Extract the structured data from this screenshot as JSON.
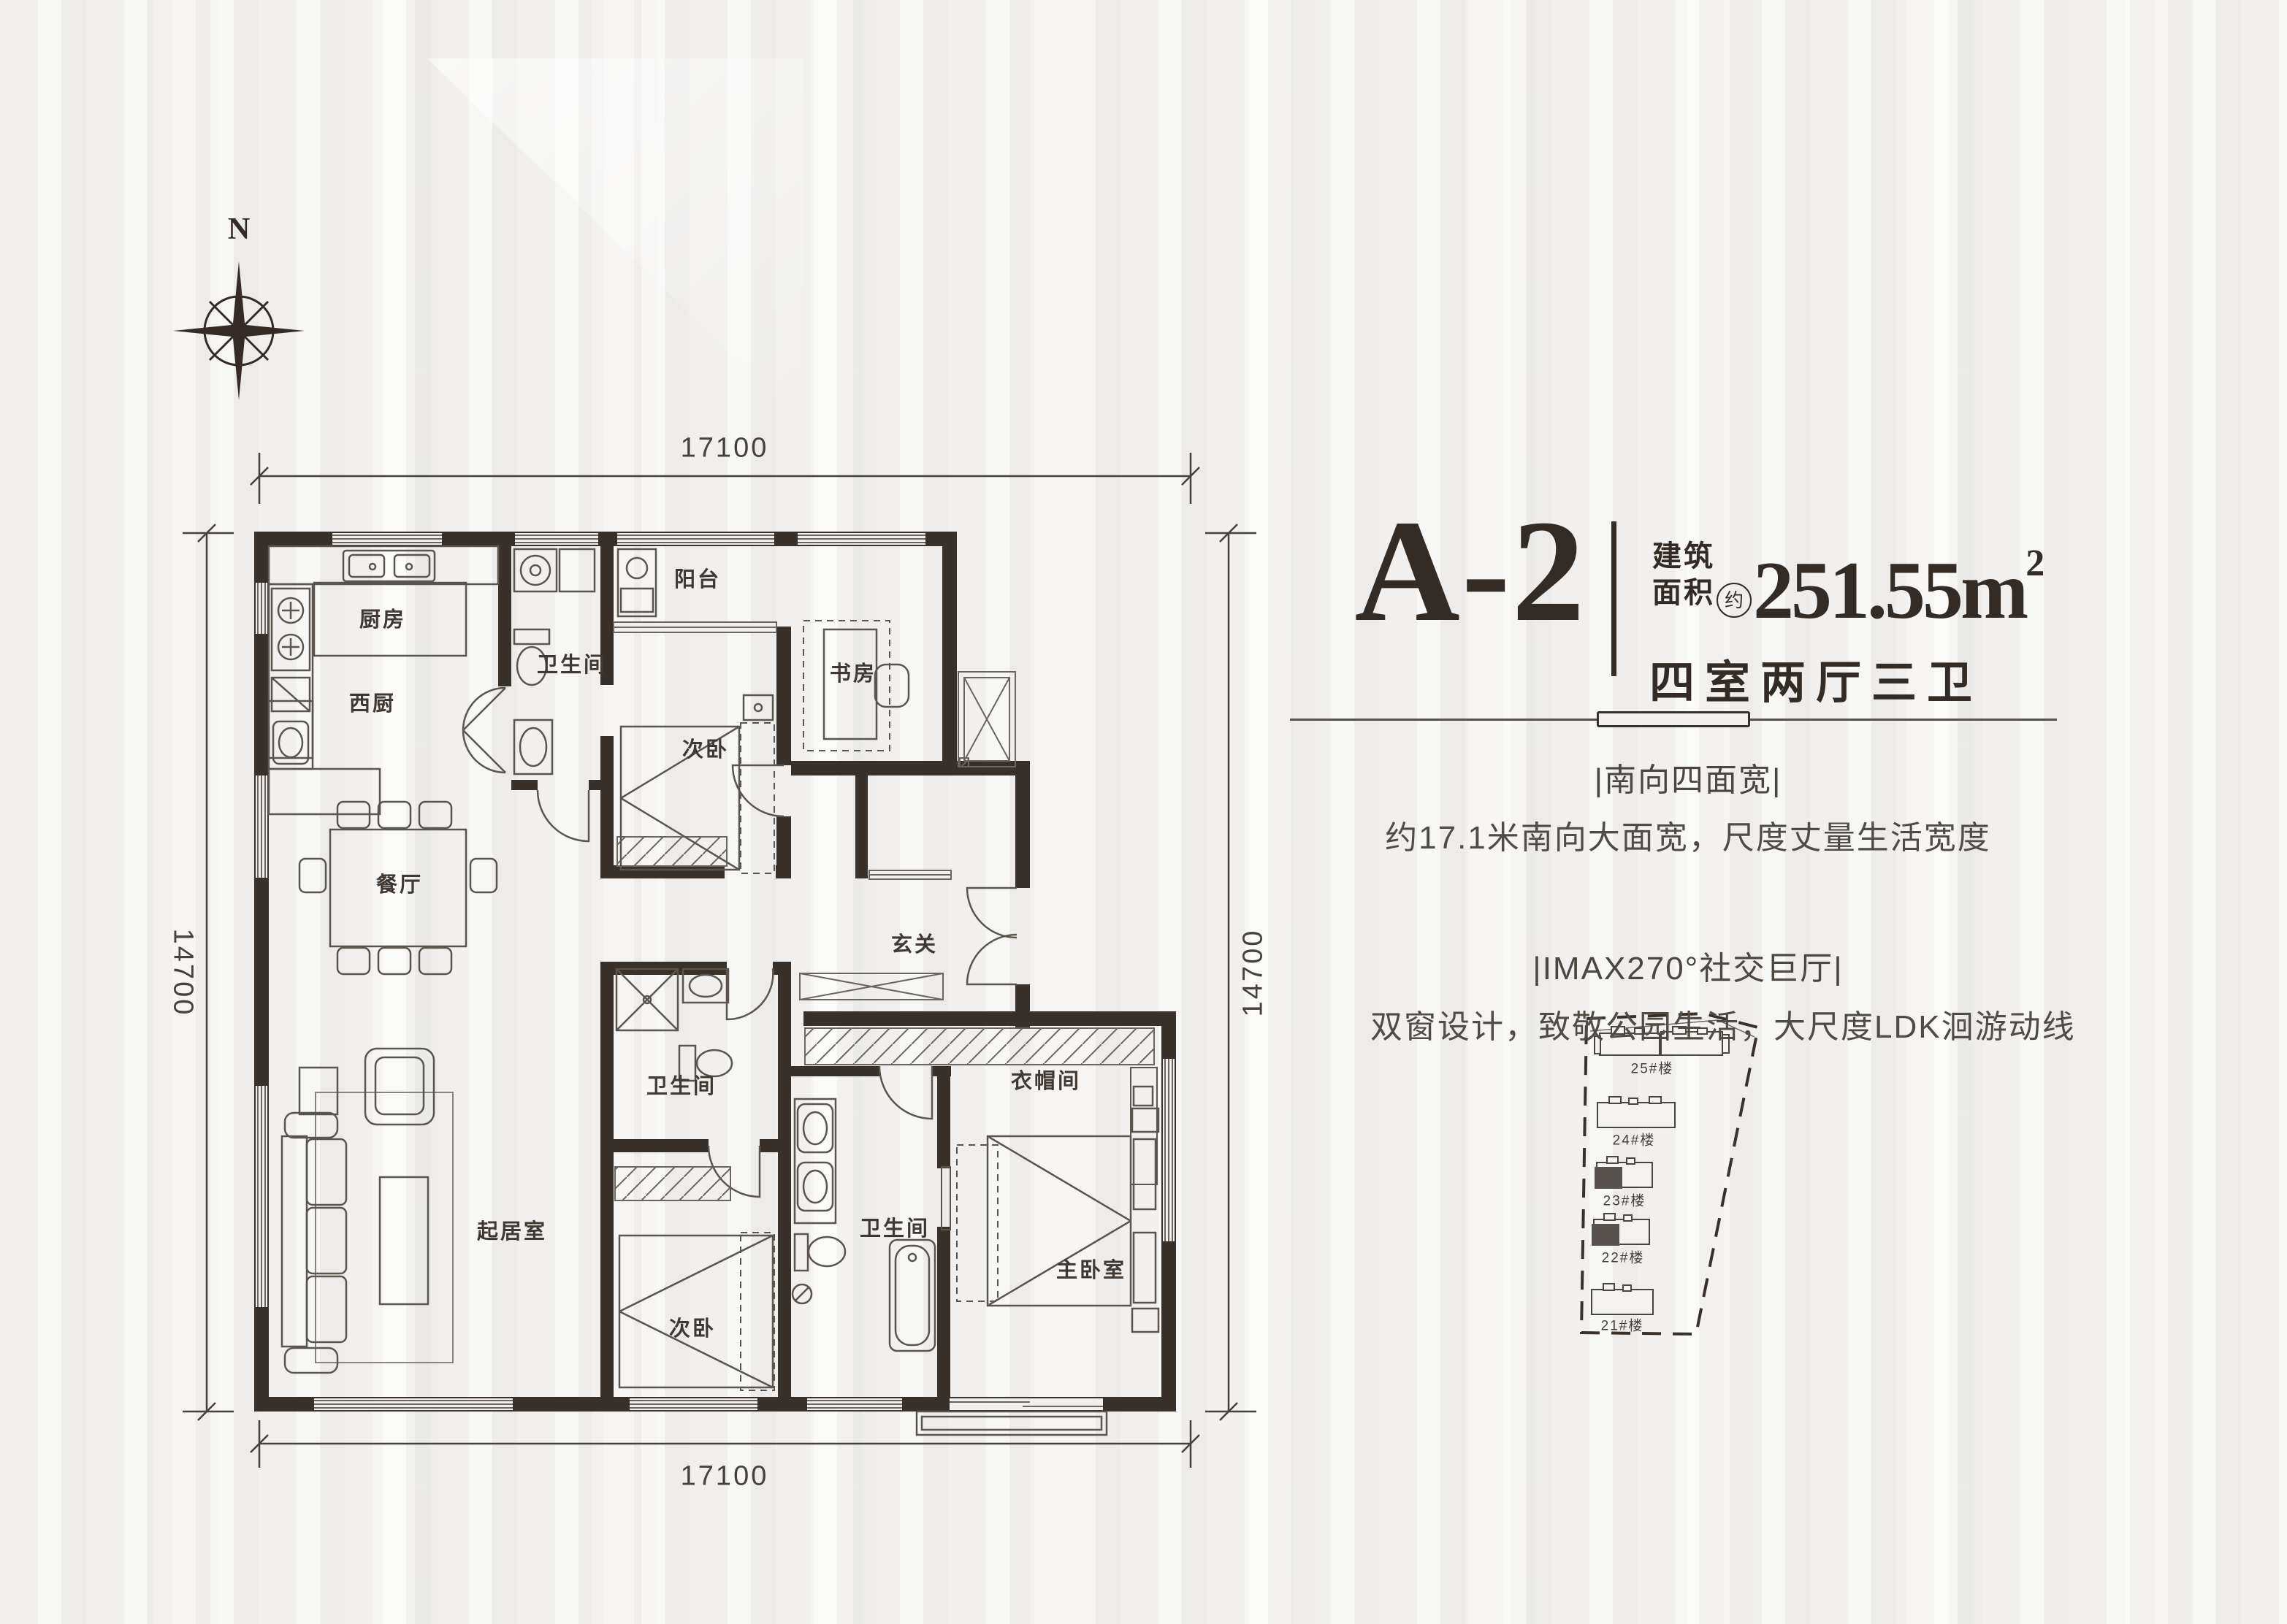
{
  "colors": {
    "background": "#f1f0ee",
    "ink": "#38302a",
    "line": "#5b554f",
    "text": "#46413c",
    "highlight": "#57524d"
  },
  "compass": {
    "label": "N"
  },
  "dimensions": {
    "top": "17100",
    "bottom": "17100",
    "left": "14700",
    "right": "14700"
  },
  "rooms": {
    "kitchen": "厨房",
    "west_kitchen": "西厨",
    "bath1": "卫生间",
    "balcony": "阳台",
    "bed2": "次卧",
    "study": "书房",
    "foyer": "玄关",
    "dining": "餐厅",
    "living": "起居室",
    "bath2": "卫生间",
    "bed3": "次卧",
    "cloak": "衣帽间",
    "bath_master": "卫生间",
    "master": "主卧室"
  },
  "title": {
    "code": "A-2",
    "area_label_line1": "建筑",
    "area_label_line2": "面积",
    "approx_mark": "约",
    "area_value": "251.55",
    "area_unit": "m",
    "area_exponent": "2",
    "layout_text": "四室两厅三卫"
  },
  "selling_points": [
    {
      "headline": "|南向四面宽|",
      "body": "约17.1米南向大面宽，尺度丈量生活宽度"
    },
    {
      "headline": "|IMAX270°社交巨厅|",
      "body": "双窗设计，致敬公园生活，大尺度LDK洄游动线"
    }
  ],
  "site_plan": {
    "buildings": [
      {
        "name": "25#楼",
        "highlighted": false
      },
      {
        "name": "24#楼",
        "highlighted": false
      },
      {
        "name": "23#楼",
        "highlighted": true
      },
      {
        "name": "22#楼",
        "highlighted": true
      },
      {
        "name": "21#楼",
        "highlighted": false
      }
    ]
  }
}
